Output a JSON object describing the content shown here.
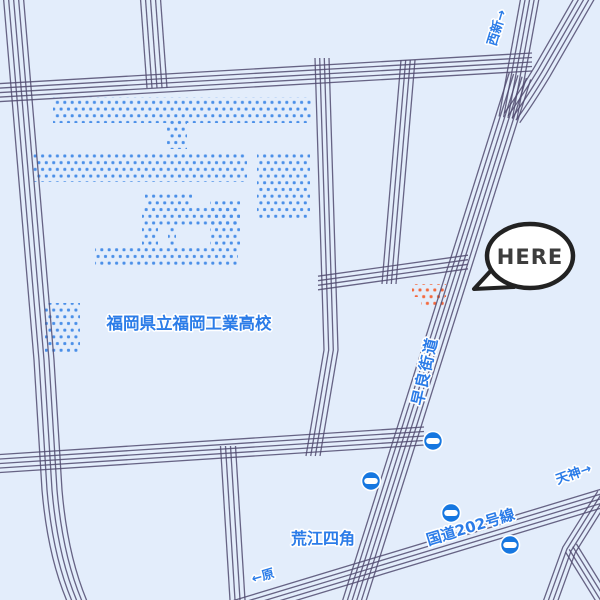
{
  "map": {
    "marker": {
      "label": "HERE"
    },
    "labels": {
      "school": "福岡県立福岡工業高校",
      "direction_nishijin": "西新→",
      "road_sawara_kaido": "早良街道",
      "direction_tenjin": "天神→",
      "road_route202": "国道202号線",
      "intersection_arae_yonkado": "荒江四角",
      "direction_hara": "←原"
    },
    "icons": {
      "traffic_light": "traffic-light-icon"
    },
    "colors": {
      "background": "#e3edfb",
      "road_line": "#514b70",
      "school_building_dots": "#4a8fe8",
      "destination_building_dots": "#f4683c",
      "label_text": "#2b7ce8",
      "traffic_light": "#1677e0",
      "bubble_outline": "#222222",
      "bubble_fill": "#ffffff"
    }
  }
}
